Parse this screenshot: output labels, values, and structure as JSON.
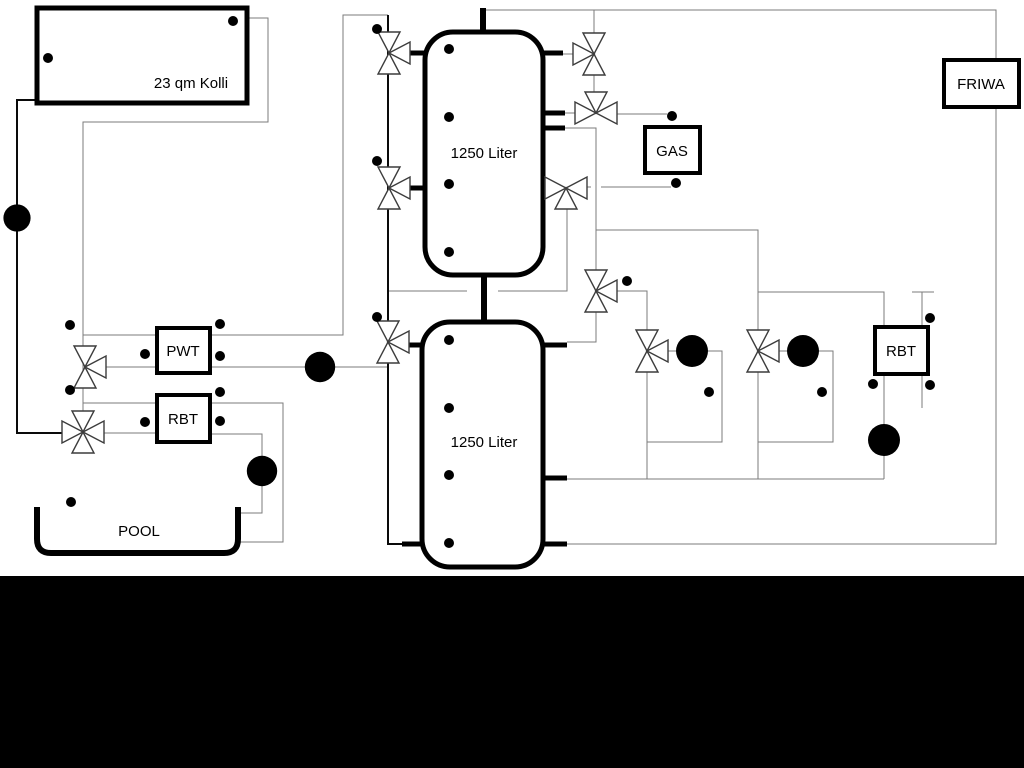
{
  "diagram": {
    "labels": {
      "collector": "23 qm Kolli",
      "tank1": "1250 Liter",
      "tank2": "1250 Liter",
      "pwt": "PWT",
      "rbt_left": "RBT",
      "gas": "GAS",
      "rbt_right": "RBT",
      "friwa": "FRIWA",
      "pool": "POOL"
    },
    "colors": {
      "pipe_gray": "#7b7b7b",
      "pipe_black": "#0a0a0a",
      "component_outline": "#000000",
      "background": "#ffffff",
      "bottom_band": "#000000"
    },
    "components": {
      "boxes": [
        "solar-collector",
        "buffer-tank-1",
        "buffer-tank-2",
        "pwt-heat-exchanger",
        "rbt-left",
        "gas-boiler",
        "rbt-right",
        "friwa-station",
        "pool-basin"
      ],
      "pump_icons": [
        "solar-pump",
        "pwt-pump",
        "heating-pump-1",
        "heating-pump-2",
        "rbt-pump",
        "pool-pump"
      ],
      "valve_icons": [
        "valve-tank1-top-left",
        "valve-tank1-mid-left",
        "valve-tank2-top-left",
        "valve-tank1-top-right",
        "valve-gas-supply",
        "valve-tank1-bottom-right",
        "valve-heating-feed",
        "valve-heating-circuit-1",
        "valve-heating-circuit-2",
        "valve-pwt-return",
        "valve-solar-return"
      ],
      "sensor_icon": "temperature-sensor"
    }
  }
}
